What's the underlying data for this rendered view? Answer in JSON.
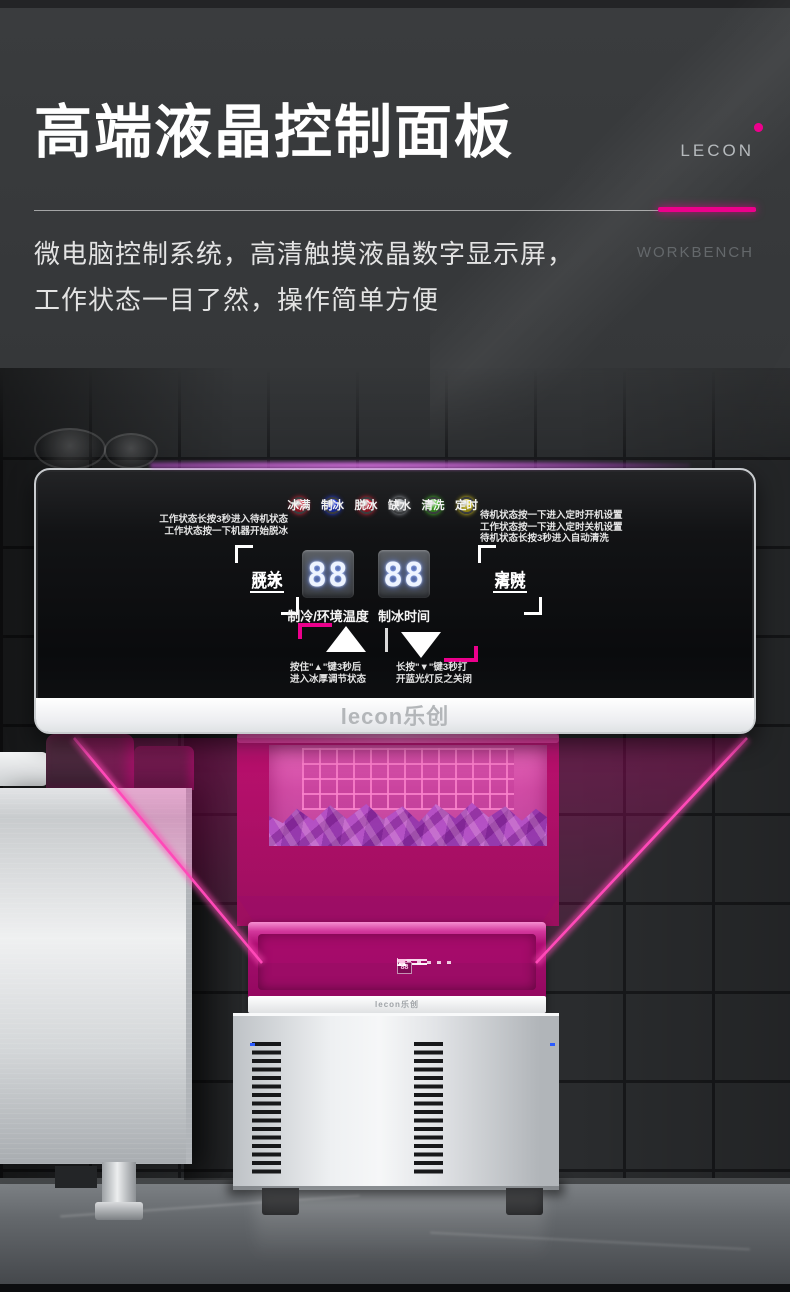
{
  "header": {
    "title": "高端液晶控制面板",
    "subtitle1": "微电脑控制系统，高清触摸液晶数字显示屏，",
    "subtitle2": "工作状态一目了然，操作简单方便",
    "brand": "LECON",
    "brand_sub": "WORKBENCH",
    "dot_colors": [
      "#63294a",
      "#aa2673",
      "#ec008c"
    ]
  },
  "panel": {
    "logo": "lecon乐创",
    "indicators": [
      {
        "label": "冰满",
        "color": "#e02438"
      },
      {
        "label": "制冰",
        "color": "#2742f0"
      },
      {
        "label": "脱冰",
        "color": "#e02438"
      },
      {
        "label": "缺水",
        "color": "#a8adb2"
      },
      {
        "label": "清洗",
        "color": "#4ed32c"
      },
      {
        "label": "定时",
        "color": "#efdb1e"
      }
    ],
    "note_left": [
      "工作状态长按3秒进入待机状态",
      "工作状态按一下机器开始脱冰"
    ],
    "note_right": [
      "待机状态按一下进入定时开机设置",
      "工作状态按一下进入定时关机设置",
      "待机状态长按3秒进入自动清洗"
    ],
    "btn_left": {
      "line1": "开关",
      "line2": "脱冰"
    },
    "btn_right": {
      "line1": "定时",
      "line2": "清洗"
    },
    "displays": [
      {
        "value": "88",
        "label": "制冷/环境温度"
      },
      {
        "value": "88",
        "label": "制冰时间"
      }
    ],
    "note_up": [
      "按住\"▲\"键3秒后",
      "进入冰厚调节状态"
    ],
    "note_down": [
      "长按\"▼\"键3秒打",
      "开蓝光灯反之关闭"
    ]
  },
  "machine": {
    "logo": "lecon乐创"
  },
  "colors": {
    "accent": "#ec008c",
    "beam": "#ff49b8",
    "panel_glow": "#c353d6"
  }
}
